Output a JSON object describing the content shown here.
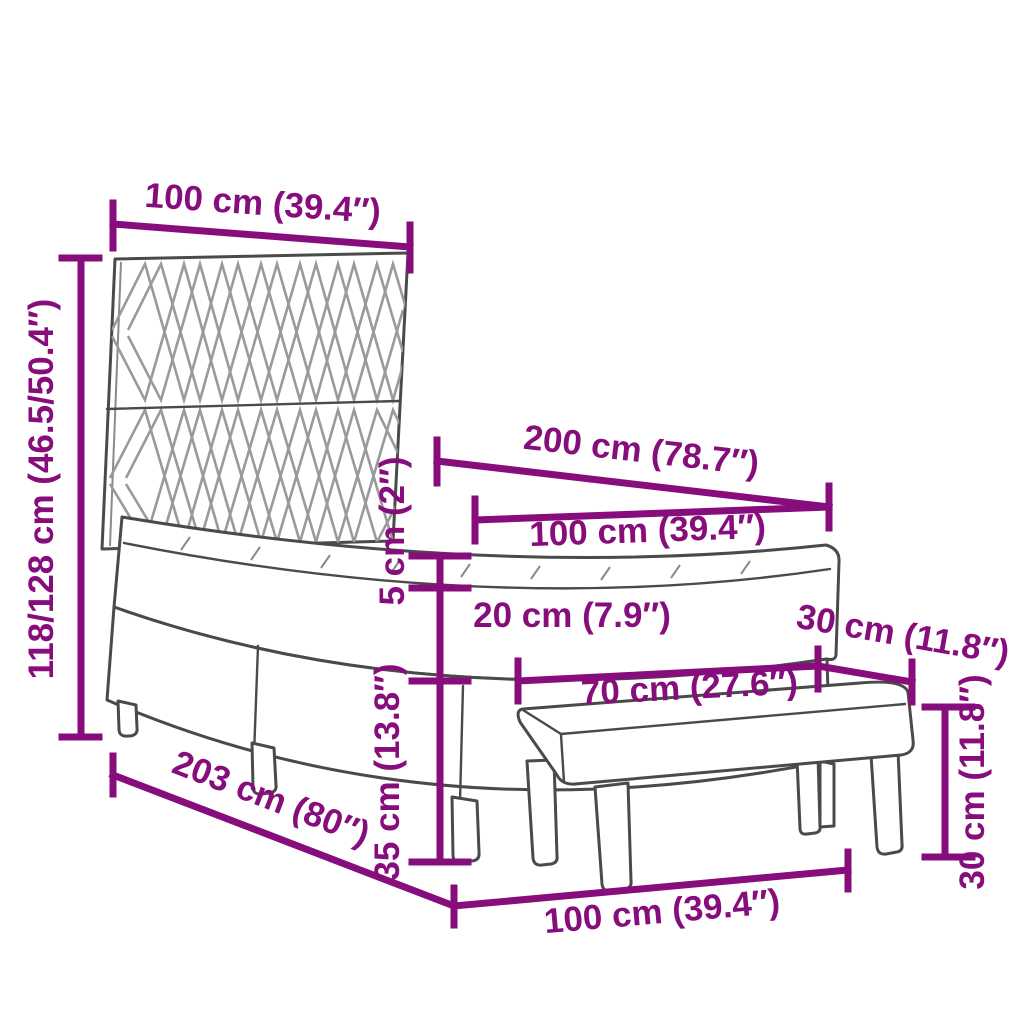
{
  "diagram": {
    "title": "Box spring bed with headboard and bench — dimension diagram",
    "colors": {
      "dimension": "#860D7B",
      "outline": "#4a4a4a",
      "pattern": "#9a9a9a",
      "background": "#ffffff"
    },
    "dimensions": {
      "headboard_width": "100 cm (39.4″)",
      "overall_height": "118/128 cm (46.5/50.4″)",
      "bed_length": "200 cm (78.7″)",
      "mattress_width": "100 cm (39.4″)",
      "topper_thickness": "5 cm (2″)",
      "mattress_thickness": "20 cm (7.9″)",
      "base_height": "35 cm (13.8″)",
      "bench_length": "70 cm (27.6″)",
      "bench_depth": "30 cm (11.8″)",
      "bench_height": "30 cm (11.8″)",
      "floor_length": "203 cm (80″)",
      "floor_width": "100 cm (39.4″)"
    }
  }
}
